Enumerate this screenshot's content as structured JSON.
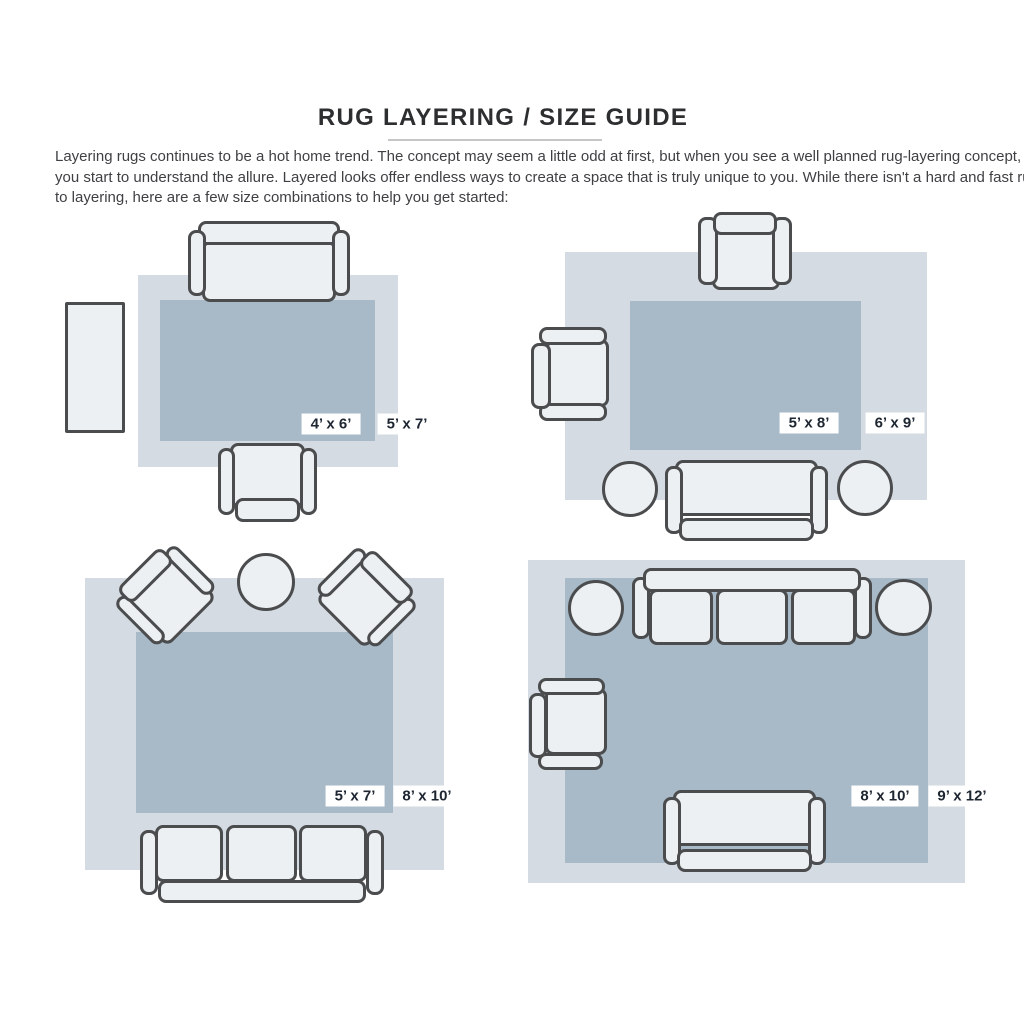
{
  "header": {
    "title": "RUG LAYERING / SIZE GUIDE",
    "intro_lines": [
      "Layering rugs continues to be a hot home trend. The concept may seem a little odd at first, but when you see a well planned rug-layering concept,",
      "you start to understand the allure. Layered looks offer endless ways to create a space that is truly unique to you. While there isn't a hard and fast rule",
      "to layering, here are a few size combinations to help you get started:"
    ]
  },
  "colors": {
    "page_bg": "#ffffff",
    "outer_rug": "#d4dbe2",
    "inner_rug": "#a8bac7",
    "furniture_fill": "#edf0f2",
    "furniture_border": "#4b4c4e",
    "label_bg": "#ffffff",
    "label_text": "#1e2631",
    "title_text": "#2d2e30",
    "body_text": "#3f4043",
    "divider": "#c6c6c6"
  },
  "layouts": [
    {
      "id": "top-left",
      "inner_rug_size": "4’ x 6’",
      "outer_rug_size": "5’ x 7’"
    },
    {
      "id": "top-right",
      "inner_rug_size": "5’ x 8’",
      "outer_rug_size": "6’ x 9’"
    },
    {
      "id": "bottom-left",
      "inner_rug_size": "5’ x 7’",
      "outer_rug_size": "8’ x 10’"
    },
    {
      "id": "bottom-right",
      "inner_rug_size": "8’ x 10’",
      "outer_rug_size": "9’ x 12’"
    }
  ]
}
